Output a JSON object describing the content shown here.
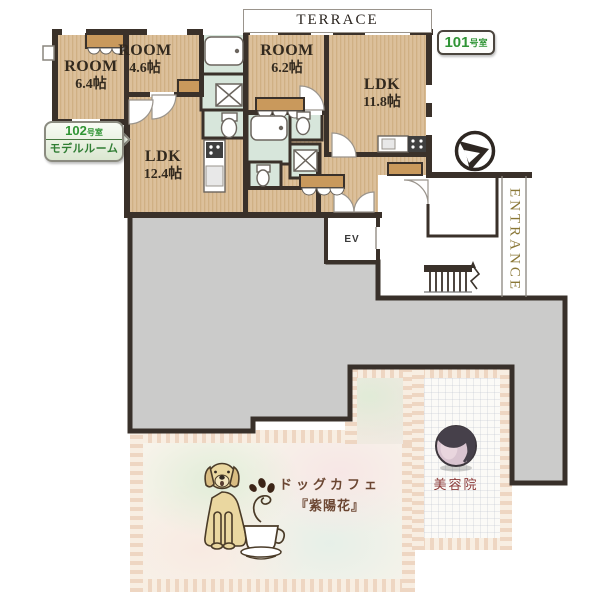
{
  "labels": {
    "terrace": "TERRACE",
    "entrance": "ENTRANCE",
    "elevator": "EV"
  },
  "badges": {
    "unit101": {
      "number": "101",
      "suffix": "号室"
    },
    "unit102": {
      "number": "102",
      "suffix": "号室",
      "subtitle": "モデルルーム"
    }
  },
  "rooms": {
    "room64": {
      "label": "ROOM",
      "size": "6.4帖"
    },
    "room46": {
      "label": "ROOM",
      "size": "4.6帖"
    },
    "room62": {
      "label": "ROOM",
      "size": "6.2帖"
    },
    "ldk118": {
      "label": "LDK",
      "size": "11.8帖"
    },
    "ldk124": {
      "label": "LDK",
      "size": "12.4帖"
    }
  },
  "shops": {
    "dog_cafe": {
      "line1": "ドッグカフェ",
      "line2": "『紫陽花』"
    },
    "salon": {
      "label": "美容院"
    }
  },
  "icons": {
    "compass": "north-compass",
    "dog": "golden-retriever",
    "coffee_cup": "coffee-cup",
    "salon_icon": "woman-profile"
  },
  "colors": {
    "floor_tan": "#dcc09b",
    "wall_dark": "#3a312a",
    "wet_green": "#d7e6db",
    "closet_tan": "#c9995c",
    "common_gray": "#cbcbca",
    "stripe_dark": "#eed6c2",
    "stripe_light": "#f8eee2",
    "badge_green": "#2f9434",
    "entrance_text": "#8a7736",
    "cafe_text": "#6b4632",
    "salon_text": "#8c3a38"
  }
}
